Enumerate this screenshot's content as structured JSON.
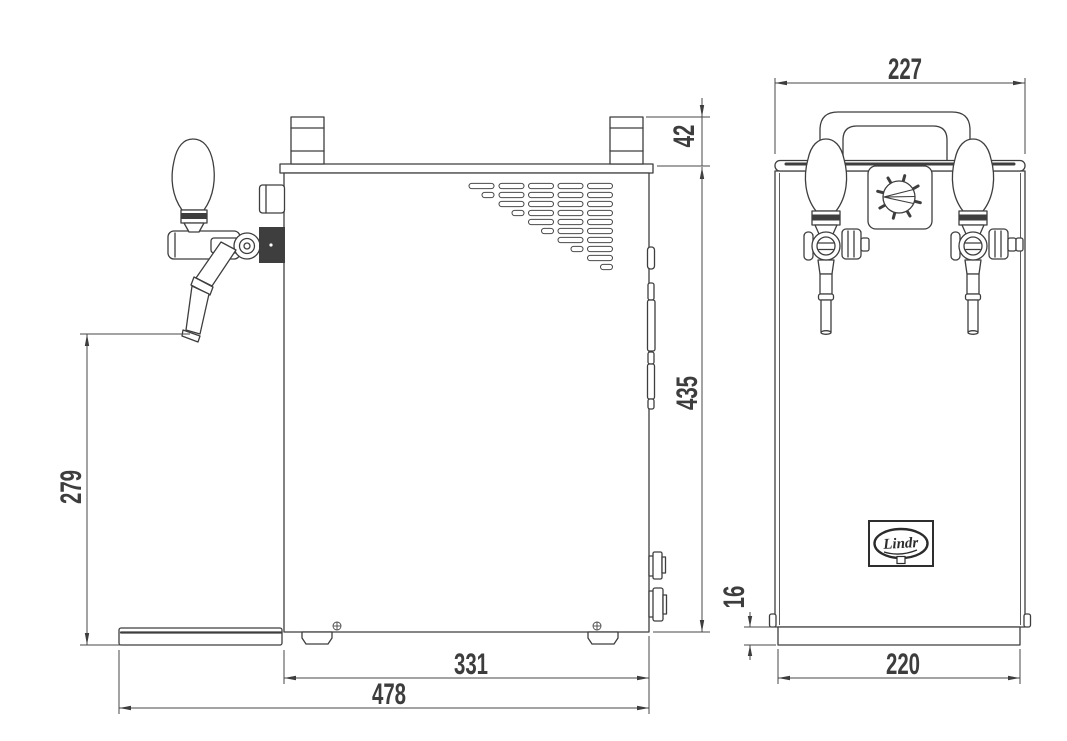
{
  "colors": {
    "line": "#3e3e3e",
    "background": "#ffffff"
  },
  "side_view": {
    "dimensions": {
      "riser_height": "42",
      "body_height": "435",
      "tap_to_ground": "279",
      "body_depth": "331",
      "overall_depth": "478"
    }
  },
  "front_view": {
    "dimensions": {
      "body_width": "227",
      "base_height": "16",
      "base_width": "220"
    },
    "logo": {
      "text": "Lindr"
    }
  }
}
